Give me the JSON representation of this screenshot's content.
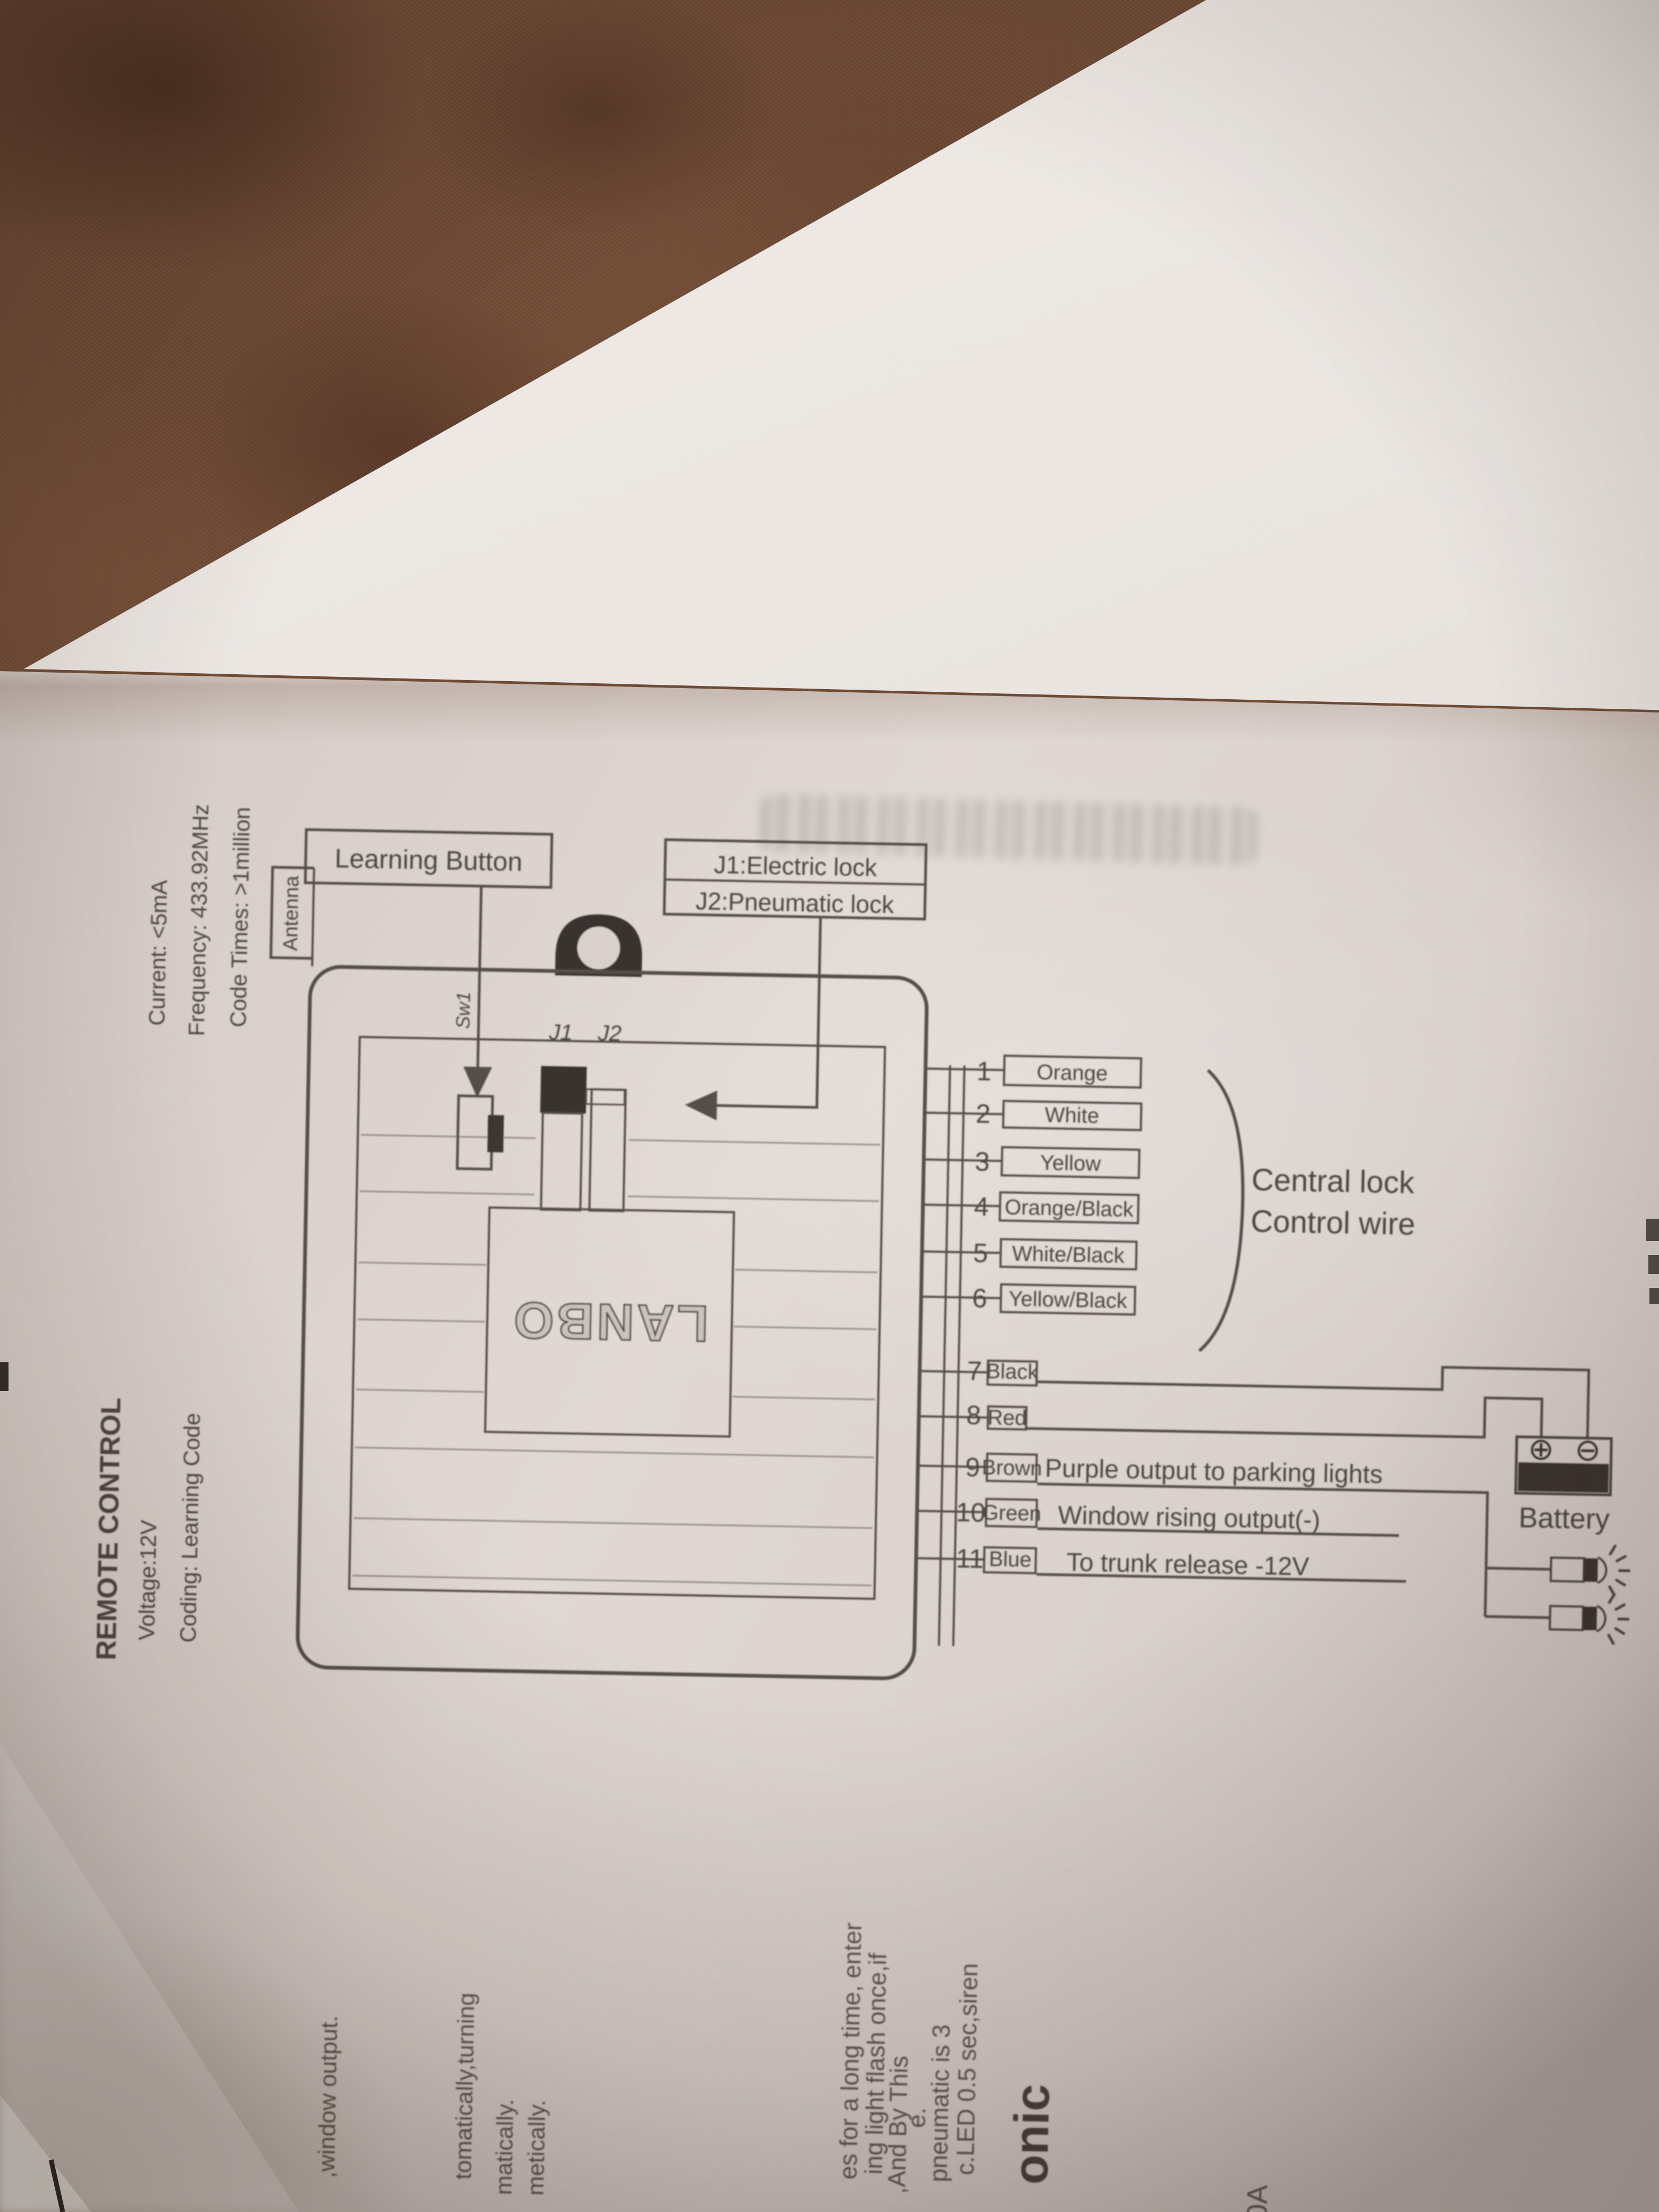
{
  "labels": {
    "learning_button": "Learning Button",
    "j1_lock": "J1:Electric lock",
    "j2_lock": "J2:Pneumatic lock",
    "antenna": "Antenna",
    "sw1": "Sw1",
    "j1": "J1",
    "j2": "J2",
    "brand": "LANBO",
    "central_lock_line1": "Central lock",
    "central_lock_line2": "Control wire",
    "battery": "Battery"
  },
  "icons": {
    "battery_plus": "⊕",
    "battery_minus": "⊖"
  },
  "specs": {
    "title": "REMOTE CONTROL",
    "voltage": "Voltage:12V",
    "coding": "Coding: Learning Code",
    "current": "Current: <5mA",
    "frequency": "Frequency: 433.92MHz",
    "code_times": "Code Times: >1million"
  },
  "wires": [
    {
      "num": "1",
      "color": "Orange",
      "note": ""
    },
    {
      "num": "2",
      "color": "White",
      "note": ""
    },
    {
      "num": "3",
      "color": "Yellow",
      "note": ""
    },
    {
      "num": "4",
      "color": "Orange/Black",
      "note": ""
    },
    {
      "num": "5",
      "color": "White/Black",
      "note": ""
    },
    {
      "num": "6",
      "color": "Yellow/Black",
      "note": ""
    },
    {
      "num": "7",
      "color": "Black",
      "note": ""
    },
    {
      "num": "8",
      "color": "Red",
      "note": ""
    },
    {
      "num": "9",
      "color": "Brown",
      "note": "Purple output to parking lights"
    },
    {
      "num": "10",
      "color": "Green",
      "note": "Window rising output(-)"
    },
    {
      "num": "11",
      "color": "Blue",
      "note": "To trunk release -12V"
    }
  ],
  "fragments": [
    ",window output.",
    "tomatically,turning",
    "matically.",
    "metically.",
    "es for a long time, enter",
    "ing light flash once,if",
    ",And By This",
    "e.",
    "pneumatic is 3",
    "c.LED 0.5 sec,siren",
    "onic",
    "0A"
  ]
}
